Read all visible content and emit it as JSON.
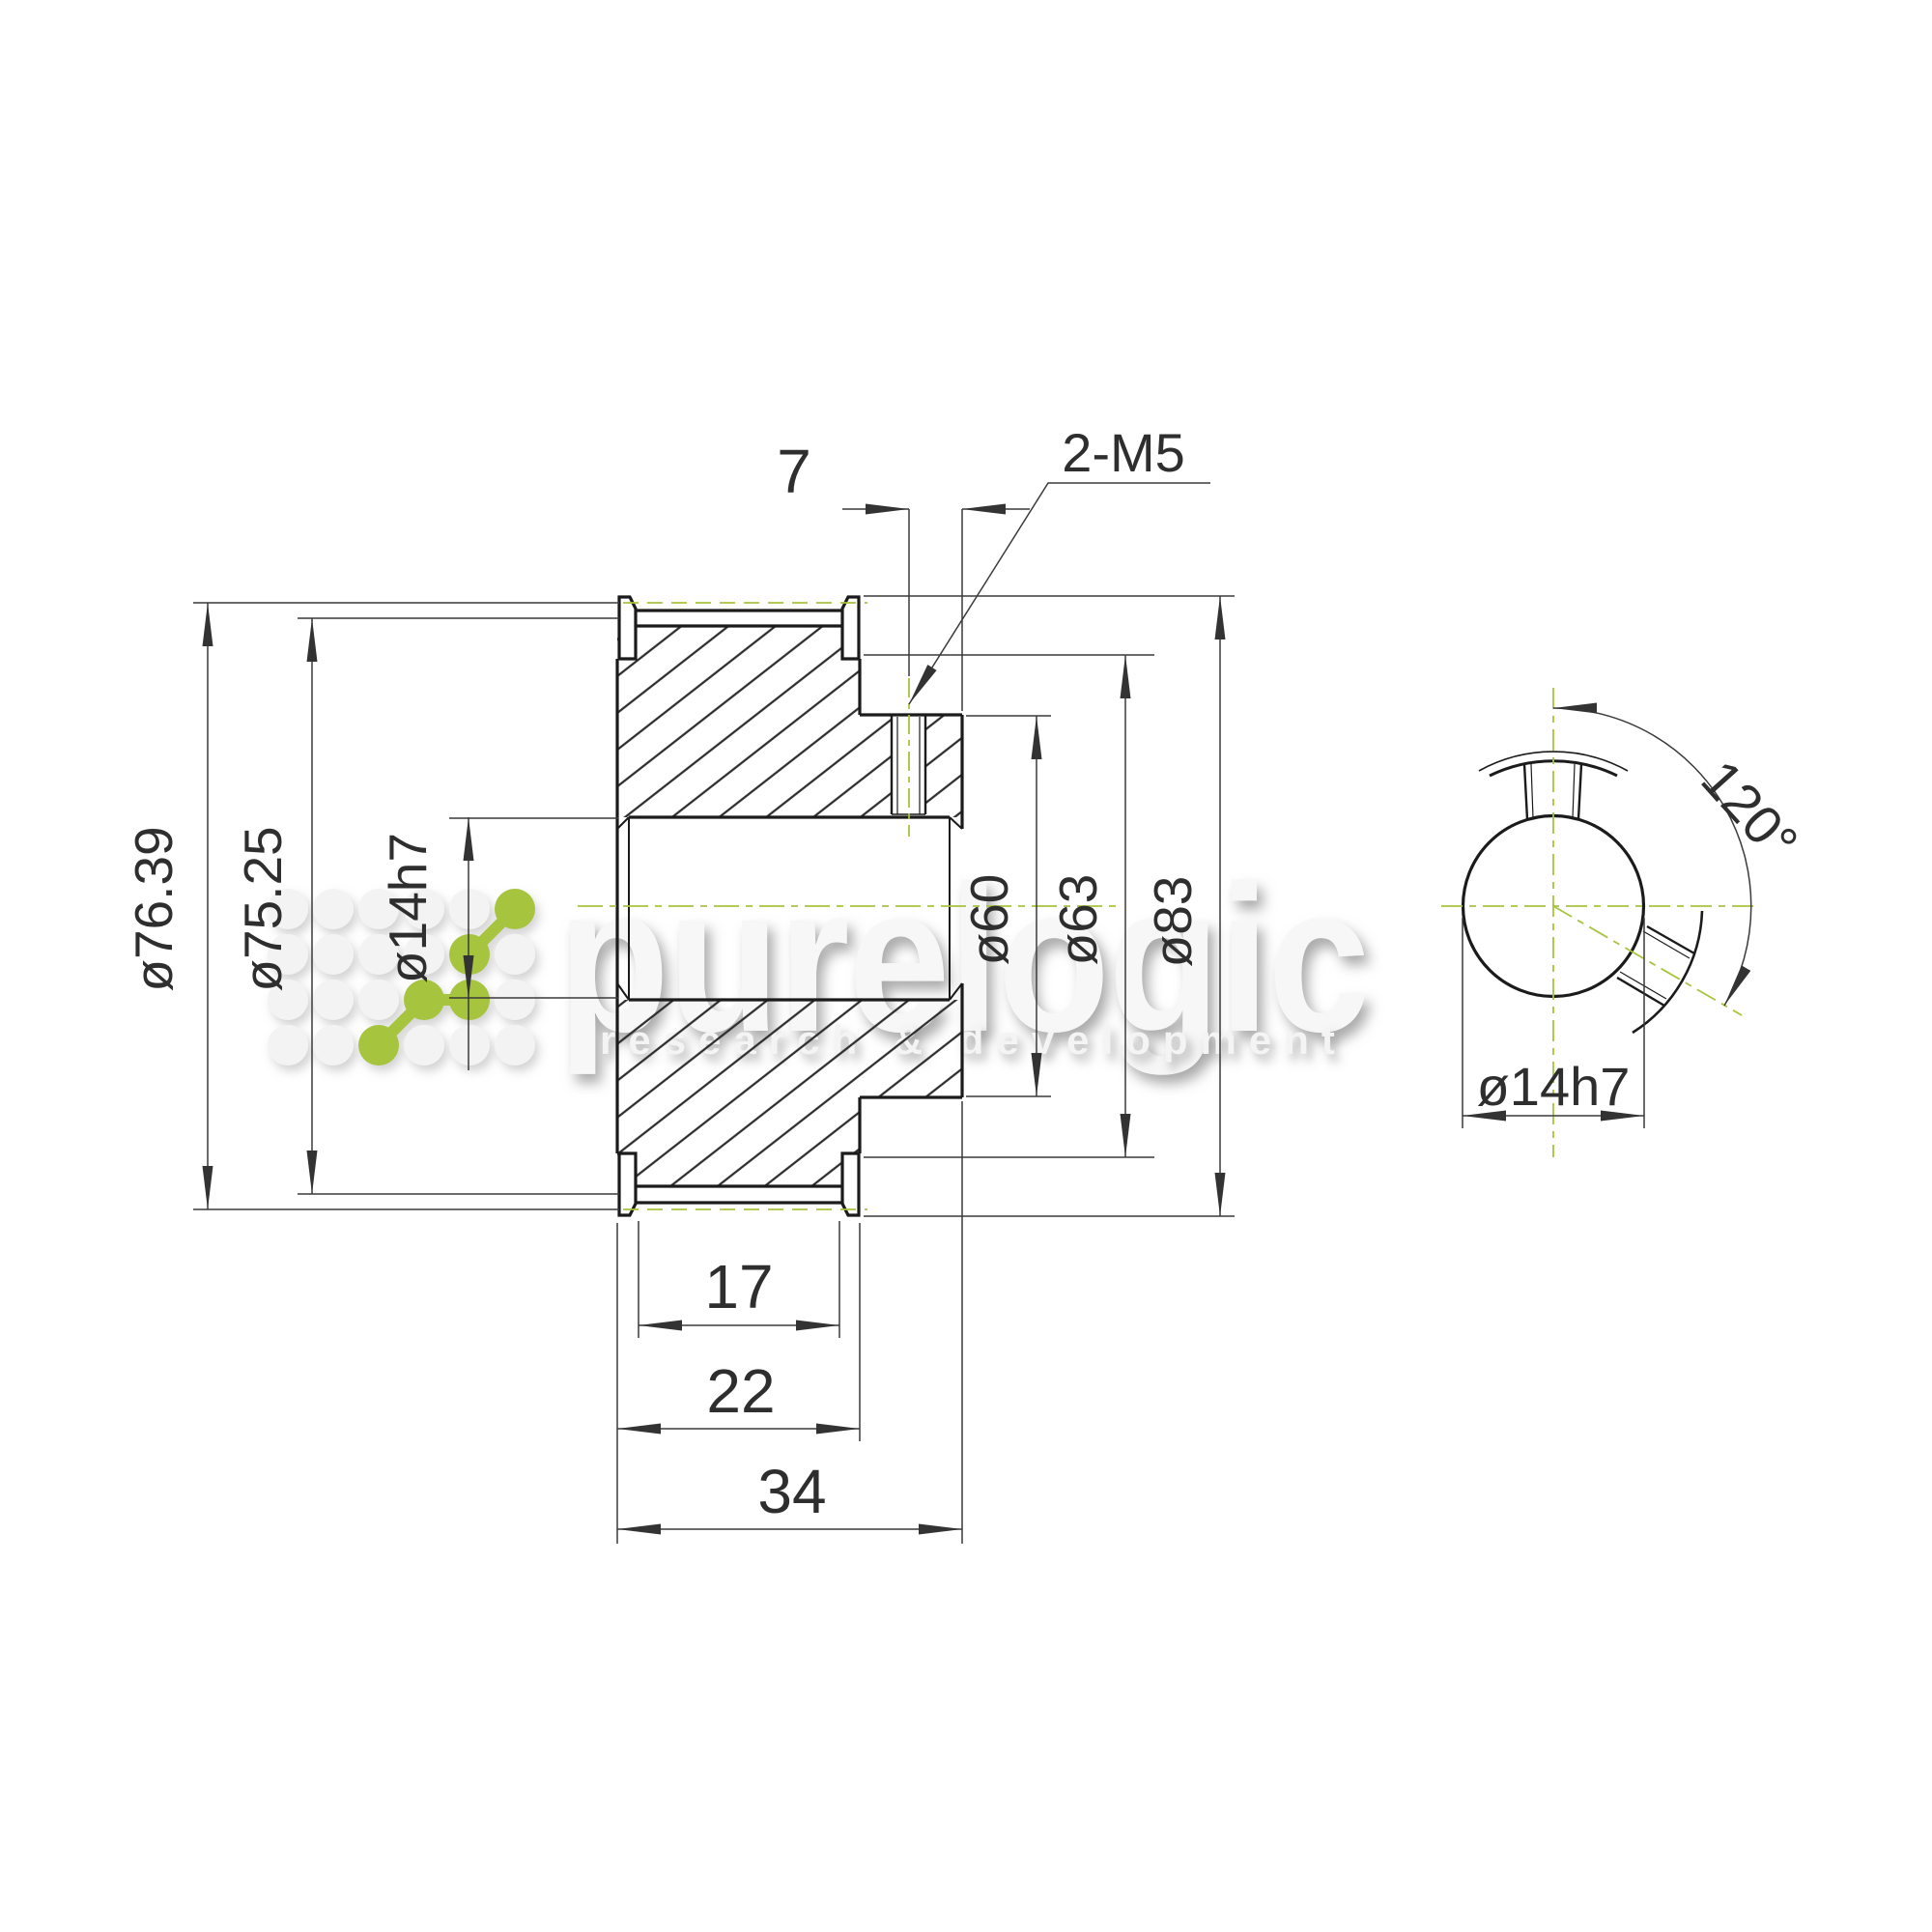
{
  "section_view": {
    "dims": {
      "setscrew_offset": "7",
      "setscrew_callout": "2-M5",
      "tooth_od": "ø76.39",
      "pitch_d": "ø75.25",
      "bore": "ø14h7",
      "recess_d": "ø60",
      "hub_d": "ø63",
      "flange_d": "ø83",
      "belt_width": "17",
      "toothed_width": "22",
      "overall_length": "34"
    }
  },
  "end_view": {
    "dims": {
      "setscrew_angle": "120°",
      "bore": "ø14h7"
    }
  },
  "watermark": {
    "brand": "purelogic",
    "tagline": "research & development"
  },
  "colors": {
    "centerline_green": "#a6c43e",
    "object_line": "#1b1b1b",
    "dim_line": "#3a3a3a",
    "logo_green": "#a6c43e",
    "background": "#ffffff"
  }
}
